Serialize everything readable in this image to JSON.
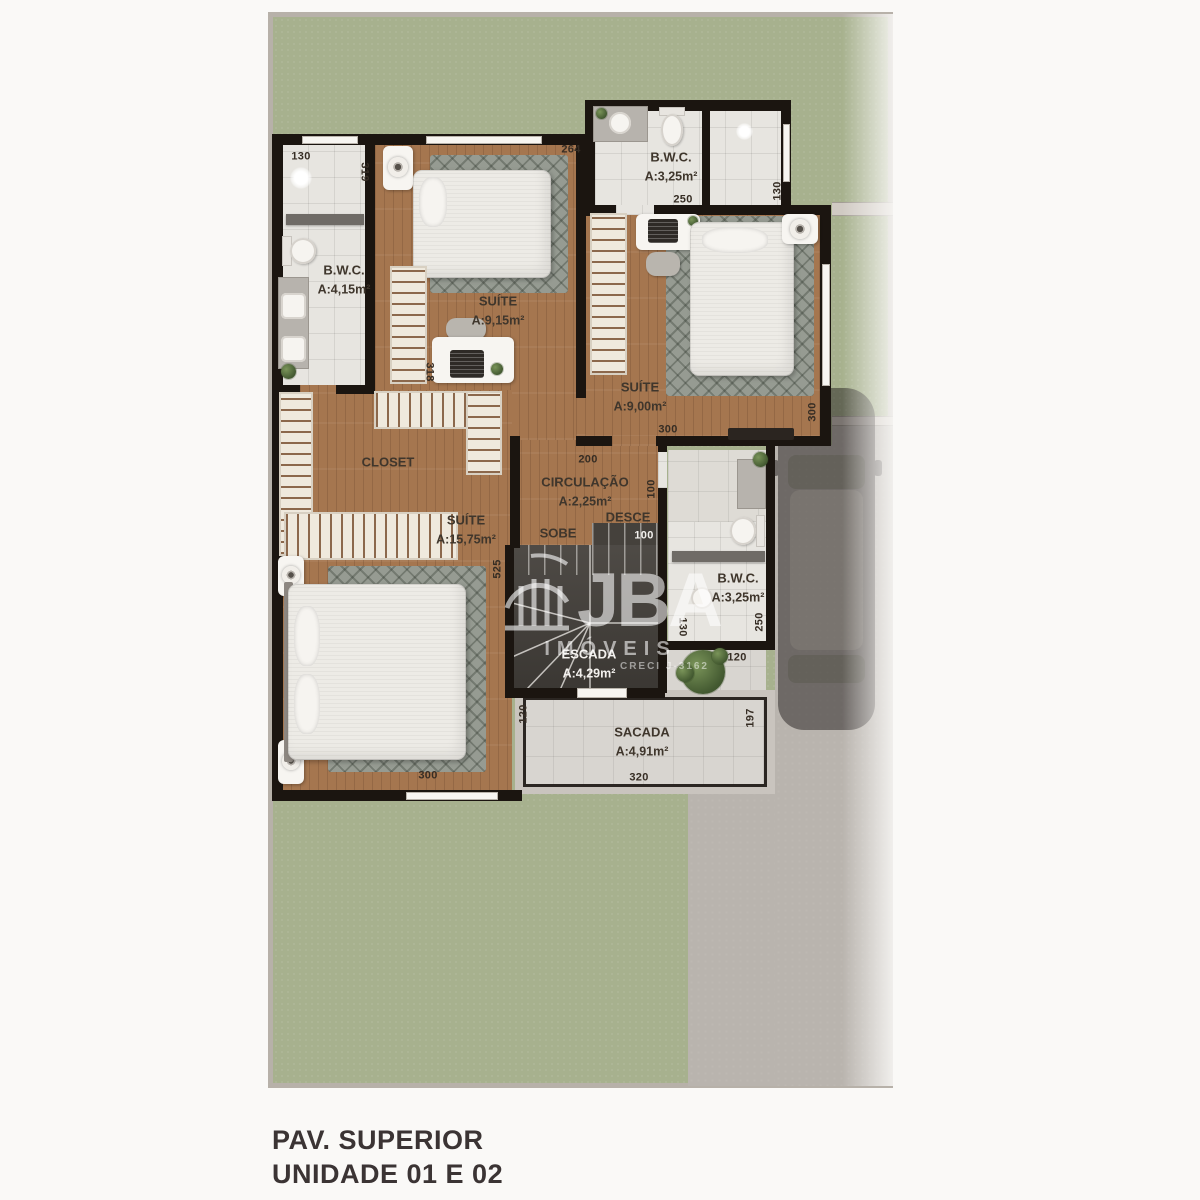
{
  "title": {
    "line1": "PAV. SUPERIOR",
    "line2": "UNIDADE 01 E 02"
  },
  "watermark": {
    "brand": "JBA",
    "subtitle": "IMÓVEIS",
    "license": "CRECI J-3162"
  },
  "stair": {
    "up": "SOBE",
    "down": "DESCE"
  },
  "rooms": [
    {
      "name": "B.W.C.",
      "area": "A:4,15m²"
    },
    {
      "name": "SUÍTE",
      "area": "A:9,15m²"
    },
    {
      "name": "B.W.C.",
      "area": "A:3,25m²"
    },
    {
      "name": "SUÍTE",
      "area": "A:9,00m²"
    },
    {
      "name": "CLOSET",
      "area": ""
    },
    {
      "name": "CIRCULAÇÃO",
      "area": "A:2,25m²"
    },
    {
      "name": "SUÍTE",
      "area": "A:15,75m²"
    },
    {
      "name": "B.W.C.",
      "area": "A:3,25m²"
    },
    {
      "name": "ESCADA",
      "area": "A:4,29m²"
    },
    {
      "name": "SACADA",
      "area": "A:4,91m²"
    }
  ],
  "dims": [
    {
      "v": "130"
    },
    {
      "v": "319"
    },
    {
      "v": "264"
    },
    {
      "v": "318"
    },
    {
      "v": "250"
    },
    {
      "v": "130"
    },
    {
      "v": "300"
    },
    {
      "v": "300"
    },
    {
      "v": "200"
    },
    {
      "v": "100"
    },
    {
      "v": "100"
    },
    {
      "v": "525"
    },
    {
      "v": "300"
    },
    {
      "v": "120"
    },
    {
      "v": "250"
    },
    {
      "v": "130"
    },
    {
      "v": "120"
    },
    {
      "v": "197"
    },
    {
      "v": "320"
    }
  ],
  "colors": {
    "grass": "#a7b18e",
    "concrete": "#b9b4ae",
    "wall": "#1b1510",
    "wood": "#a5764f",
    "tile": "#e7e5e0",
    "accent_dark": "#3b3434"
  }
}
